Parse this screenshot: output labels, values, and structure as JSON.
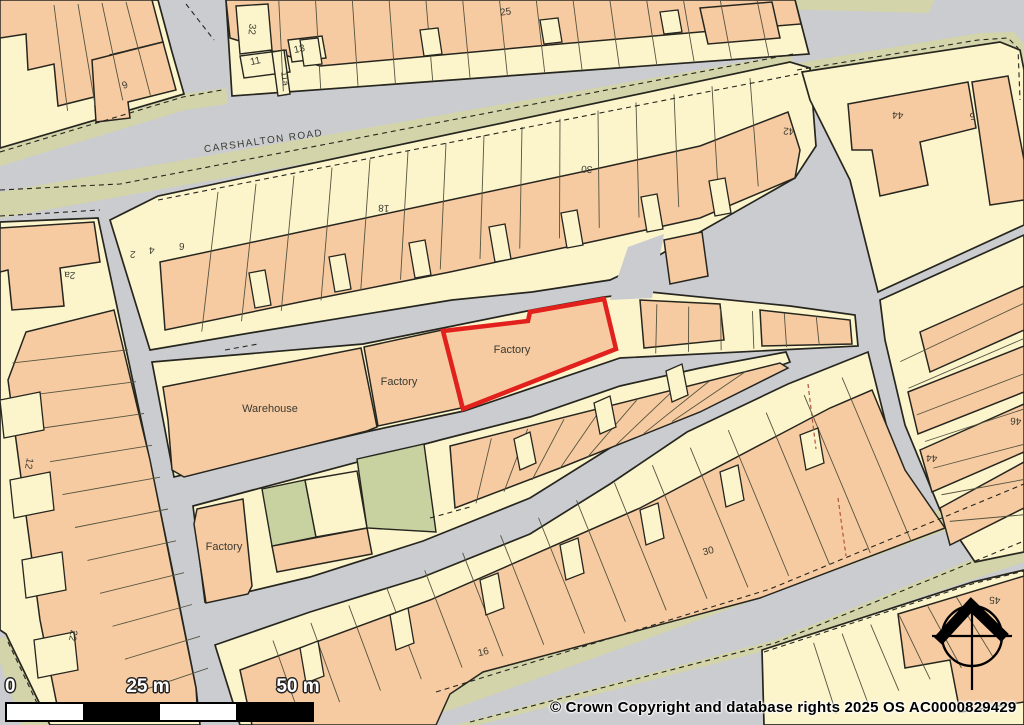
{
  "page": {
    "title": "OS site location plan"
  },
  "street": {
    "name": "CARSHALTON ROAD"
  },
  "plot": {
    "label": "Factory",
    "outline_color": "#e2211c"
  },
  "scale_bar": {
    "zero": "0",
    "mid": "25 m",
    "end": "50 m"
  },
  "copyright": {
    "text": "© Crown Copyright and database rights 2025 OS AC0000829429"
  },
  "colors": {
    "road": "#cbccd0",
    "verge": "#d3d4a9",
    "cream": "#fcf5cc",
    "orange": "#f7cba2",
    "green": "#c8d1a0",
    "line": "#26261f",
    "thin": "#55543f",
    "label": "#3a3a30",
    "red_dash": "#b2533b"
  },
  "map": {
    "verges": [
      "0,148 183,94 226,88 228,104 185,110 0,166",
      "0,192 790,54 798,76 0,218",
      "770,0 934,0 929,13 772,9",
      "792,64 980,33 1014,32 1024,44 1024,110 1008,100 1000,55 985,50 800,82",
      "430,688 1024,480 1024,502 445,712",
      "455,725 775,640 1024,538 1024,562 760,652 478,725",
      "0,638 14,635 52,725 22,725 0,662"
    ],
    "gray_patches": [
      "0,664 18,725 0,725"
    ],
    "blocks": [
      "0,0 158,0 172,52 184,94 0,148",
      "226,0 795,0 809,54 232,96",
      "110,220 158,196 790,62 810,68 816,146 795,178 640,266 610,280 532,292 452,300 256,332 150,350",
      "152,362 363,344 443,328 532,310 604,297 650,292 790,306 855,315 858,346 620,358 464,411 370,431 174,477",
      "193,506 440,440 530,417 620,386 700,368 786,352 790,362 687,400 610,448 530,498 423,541 310,577 205,602",
      "215,645 310,612 423,577 530,534 610,484 687,432 788,384 868,352 895,460 930,523 760,592 483,670 448,688 430,725 240,725",
      "0,222 98,218 122,330 148,452 172,568 196,688 200,725 50,725 6,634 0,630",
      "802,72 1000,42 1020,50 1024,70 1024,225 878,292 850,180 810,100",
      "880,300 1024,235 1024,552 975,562 940,510 905,425 885,340",
      "762,650 973,582 1024,570 1024,725 764,725"
    ],
    "road_patches": [
      "610,300 628,247 664,234 652,298"
    ],
    "buildings": [
      "0,0 152,0 163,42 110,55 114,92 58,106 54,64 28,70 26,34 0,38",
      "92,60 163,42 176,90 128,102 130,118 96,122",
      "226,0 795,0 801,24 700,32 560,44 430,56 320,66 230,38",
      "700,8 772,2 780,38 708,44",
      "160,262 300,232 450,200 600,168 700,146 788,112 800,150 795,178 700,218 600,240 450,272 300,302 165,330",
      "664,240 702,232 708,276 670,284",
      "163,387 361,348 377,427 367,431 184,477 172,470 168,420",
      "364,347 442,330 461,408 378,426",
      "444,331 527,321 529,313 604,300 615,348 463,408",
      "640,300 720,304 724,340 644,348",
      "760,310 850,320 852,344 762,346",
      "197,509 243,499 252,586 248,594 206,603 194,524",
      "272,546 367,528 372,554 277,572",
      "450,446 780,363 788,368 700,412 560,468 455,508",
      "26,332 114,310 150,460 172,570 196,688 198,720 60,720 40,620 20,470 8,380",
      "0,228 94,222 100,262 60,268 64,306 12,310 8,270 0,272",
      "240,670 430,600 640,508 830,408 872,390 905,470 945,528 760,598 483,672 450,694 436,725 252,725",
      "848,104 968,82 976,128 920,142 928,185 880,196 872,150 852,150",
      "972,82 1008,76 1024,160 1024,200 990,205",
      "920,332 1024,286 1024,330 930,372",
      "908,392 1024,346 1024,392 918,434",
      "920,450 1024,404 1024,452 932,492",
      "940,508 1024,462 1024,508 950,545",
      "898,614 1024,576 1024,702 960,712 950,660 905,668"
    ],
    "cream_buildings": [
      "236,6 268,4 272,50 240,54",
      "240,56 286,50 290,72 244,78",
      "288,40 322,36 326,58 292,62",
      "272,52 284,50 290,94 278,96"
    ],
    "teeth": [
      "300,40 318,38 322,64 304,66",
      "420,30 438,28 442,54 424,56",
      "540,20 558,18 562,42 544,44",
      "660,12 678,10 682,32 664,34",
      "255,308 271,305 265,270 249,273",
      "335,292 351,289 345,254 329,257",
      "415,278 431,275 425,240 409,243",
      "495,262 511,259 505,224 489,227",
      "567,248 583,245 577,210 561,213",
      "647,232 663,229 657,194 641,197",
      "715,216 731,213 725,178 709,181",
      "300,648 318,641 324,676 306,683",
      "390,615 408,608 414,643 396,650",
      "480,580 498,573 504,608 486,615",
      "560,545 578,538 584,573 566,580",
      "640,510 658,503 664,538 646,545",
      "720,472 738,465 744,500 726,507",
      "800,435 818,428 824,463 806,470",
      "520,470 536,463 530,432 514,439",
      "600,434 616,427 610,396 594,403",
      "672,402 688,395 682,364 666,371",
      "0,400 40,392 44,430 4,438",
      "10,480 50,472 54,510 14,518",
      "22,560 62,552 66,590 26,598",
      "34,640 74,632 78,670 38,678"
    ],
    "greens": [
      "262,489 305,480 316,537 272,546",
      "357,459 424,444 436,532 367,528"
    ],
    "cream_patches": [
      "305,480 357,471 367,528 316,537"
    ],
    "dividers": [
      {
        "a": [
          30,
          6
        ],
        "b": [
          150,
          1
        ],
        "a2": [
          40,
          116
        ],
        "b2": [
          178,
          90
        ],
        "n": 4
      },
      {
        "a": [
          242,
          1
        ],
        "b": [
          794,
          1
        ],
        "a2": [
          246,
          94
        ],
        "b2": [
          806,
          53
        ],
        "n": 14
      },
      {
        "a": [
          180,
          200
        ],
        "b": [
          788,
          70
        ],
        "a2": [
          162,
          342
        ],
        "b2": [
          798,
          176
        ],
        "n": 15
      },
      {
        "a": [
          0,
          330
        ],
        "b": [
          150,
          725
        ],
        "a2": [
          120,
          318
        ],
        "b2": [
          216,
          700
        ],
        "n": 11
      },
      {
        "a": [
          235,
          658
        ],
        "b": [
          880,
          360
        ],
        "a2": [
          258,
          725
        ],
        "b2": [
          952,
          530
        ],
        "n": 16
      },
      {
        "a": [
          455,
          448
        ],
        "b": [
          782,
          362
        ],
        "a2": [
          448,
          515
        ],
        "b2": [
          700,
          410
        ],
        "n": 8
      },
      {
        "a": [
          625,
          302
        ],
        "b": [
          848,
          318
        ],
        "a2": [
          623,
          355
        ],
        "b2": [
          852,
          344
        ],
        "n": 6
      },
      {
        "a": [
          892,
          335
        ],
        "b": [
          958,
          548
        ],
        "a2": [
          1024,
          268
        ],
        "b2": [
          1024,
          550
        ],
        "n": 7
      },
      {
        "a": [
          785,
          652
        ],
        "b": [
          985,
          588
        ],
        "a2": [
          805,
          725
        ],
        "b2": [
          1024,
          645
        ],
        "n": 6
      }
    ],
    "dashes": [
      "0,152 183,97 222,90",
      "186,4 214,40",
      "0,190 120,184 793,54",
      "0,216 100,210",
      "158,200 798,74",
      "797,70 978,40 1008,38 1018,48 1020,100",
      "436,692 770,589 1024,484",
      "470,722 775,643 1024,541",
      "764,652 972,584 1024,571",
      "8,642 46,722",
      "225,350 258,344",
      "430,518 470,507"
    ],
    "red_dashes": [
      "808,384 816,449",
      "838,498 846,556"
    ],
    "red_plot": "443,331 528,321 530,312 604,299 616,349 463,409",
    "north_arrow": {
      "cx": 972,
      "cy": 636,
      "r": 30,
      "chevron": "938,641 971,605 1005,638"
    },
    "labels": [
      {
        "t": "CARSHALTON ROAD",
        "x": 264,
        "y": 144,
        "r": -8,
        "s": 10,
        "ls": 1.4,
        "name": "street-label"
      },
      {
        "t": "Factory",
        "x": 512,
        "y": 353,
        "r": 0,
        "s": 11,
        "name": "plot-label"
      },
      {
        "t": "Factory",
        "x": 399,
        "y": 385,
        "r": 0,
        "s": 11
      },
      {
        "t": "Warehouse",
        "x": 270,
        "y": 412,
        "r": 0,
        "s": 11
      },
      {
        "t": "Factory",
        "x": 224,
        "y": 550,
        "r": 0,
        "s": 11
      },
      {
        "t": "9",
        "x": 126,
        "y": 88,
        "r": -20,
        "s": 10
      },
      {
        "t": "32",
        "x": 249,
        "y": 29,
        "r": 95,
        "s": 10
      },
      {
        "t": "11",
        "x": 256,
        "y": 64,
        "r": -12,
        "s": 10
      },
      {
        "t": "13",
        "x": 300,
        "y": 52,
        "r": -12,
        "s": 10
      },
      {
        "t": "11a",
        "x": 282,
        "y": 79,
        "r": 83,
        "s": 9
      },
      {
        "t": "25",
        "x": 506,
        "y": 15,
        "r": -8,
        "s": 10
      },
      {
        "t": "2",
        "x": 133,
        "y": 251,
        "r": 184,
        "s": 10
      },
      {
        "t": "4",
        "x": 152,
        "y": 247,
        "r": 184,
        "s": 10
      },
      {
        "t": "6",
        "x": 182,
        "y": 243,
        "r": 184,
        "s": 10
      },
      {
        "t": "2a",
        "x": 70,
        "y": 272,
        "r": 184,
        "s": 10
      },
      {
        "t": "18",
        "x": 384,
        "y": 205,
        "r": 184,
        "s": 10
      },
      {
        "t": "30",
        "x": 587,
        "y": 166,
        "r": 184,
        "s": 10
      },
      {
        "t": "42",
        "x": 789,
        "y": 128,
        "r": 184,
        "s": 10
      },
      {
        "t": "44",
        "x": 898,
        "y": 112,
        "r": 184,
        "s": 10
      },
      {
        "t": "5",
        "x": 972,
        "y": 113,
        "r": 172,
        "s": 10
      },
      {
        "t": "12",
        "x": 26,
        "y": 463,
        "r": 100,
        "s": 10
      },
      {
        "t": "22",
        "x": 70,
        "y": 635,
        "r": 100,
        "s": 10
      },
      {
        "t": "16",
        "x": 484,
        "y": 655,
        "r": -14,
        "s": 10
      },
      {
        "t": "30",
        "x": 709,
        "y": 554,
        "r": -14,
        "s": 10
      },
      {
        "t": "44",
        "x": 932,
        "y": 455,
        "r": 184,
        "s": 10
      },
      {
        "t": "46",
        "x": 1016,
        "y": 418,
        "r": 184,
        "s": 10
      },
      {
        "t": "45",
        "x": 995,
        "y": 597,
        "r": 184,
        "s": 10
      }
    ]
  }
}
